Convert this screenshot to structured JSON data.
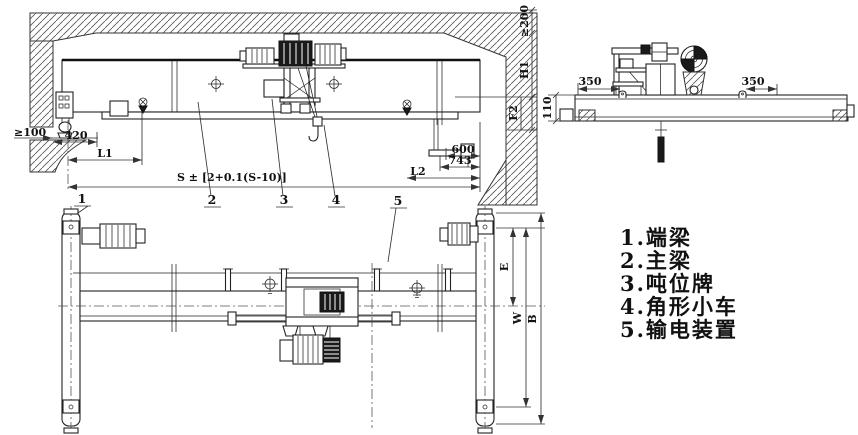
{
  "drawing": {
    "elevation": {
      "dims": {
        "side_clearance": "≥100",
        "rail_offset": "420",
        "l1": "L1",
        "span_tolerance": "S ± [2+0.1(S-10)]",
        "d600": "600",
        "d743": "743",
        "l2": "L2",
        "top_clearance": "≥200",
        "h1": "H1",
        "f2": "F2"
      },
      "callouts": [
        "1",
        "2",
        "3",
        "4",
        "5"
      ]
    },
    "end_view": {
      "dims": {
        "left_350": "350",
        "right_350": "350",
        "height_110": "110"
      }
    },
    "plan": {
      "dims": {
        "e": "E",
        "w": "W",
        "b": "B"
      }
    }
  },
  "legend": {
    "items": [
      "1.端梁",
      "2.主梁",
      "3.吨位牌",
      "4.角形小车",
      "5.输电装置"
    ]
  }
}
